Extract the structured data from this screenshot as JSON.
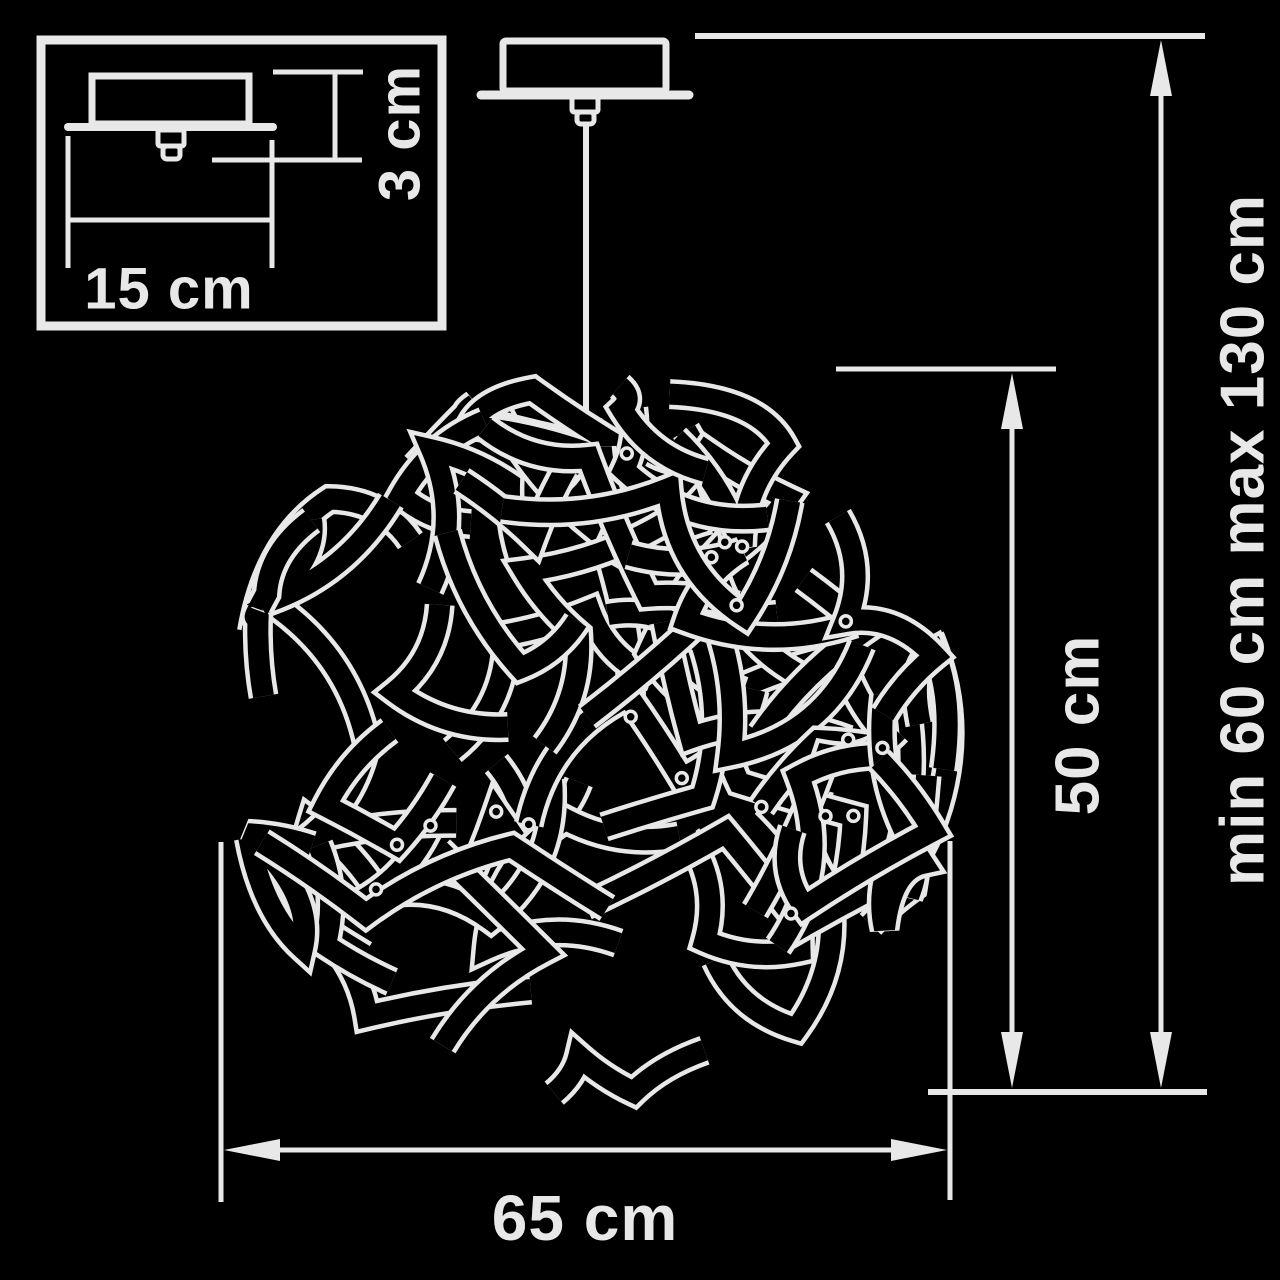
{
  "colors": {
    "background": "#000000",
    "line": "#e8e8e8"
  },
  "inset": {
    "mount_width": "15 cm",
    "mount_height": "3 cm"
  },
  "dimensions": {
    "shade_height": "50 cm",
    "overall_height": "min 60 cm max 130 cm",
    "diameter": "65 cm"
  }
}
